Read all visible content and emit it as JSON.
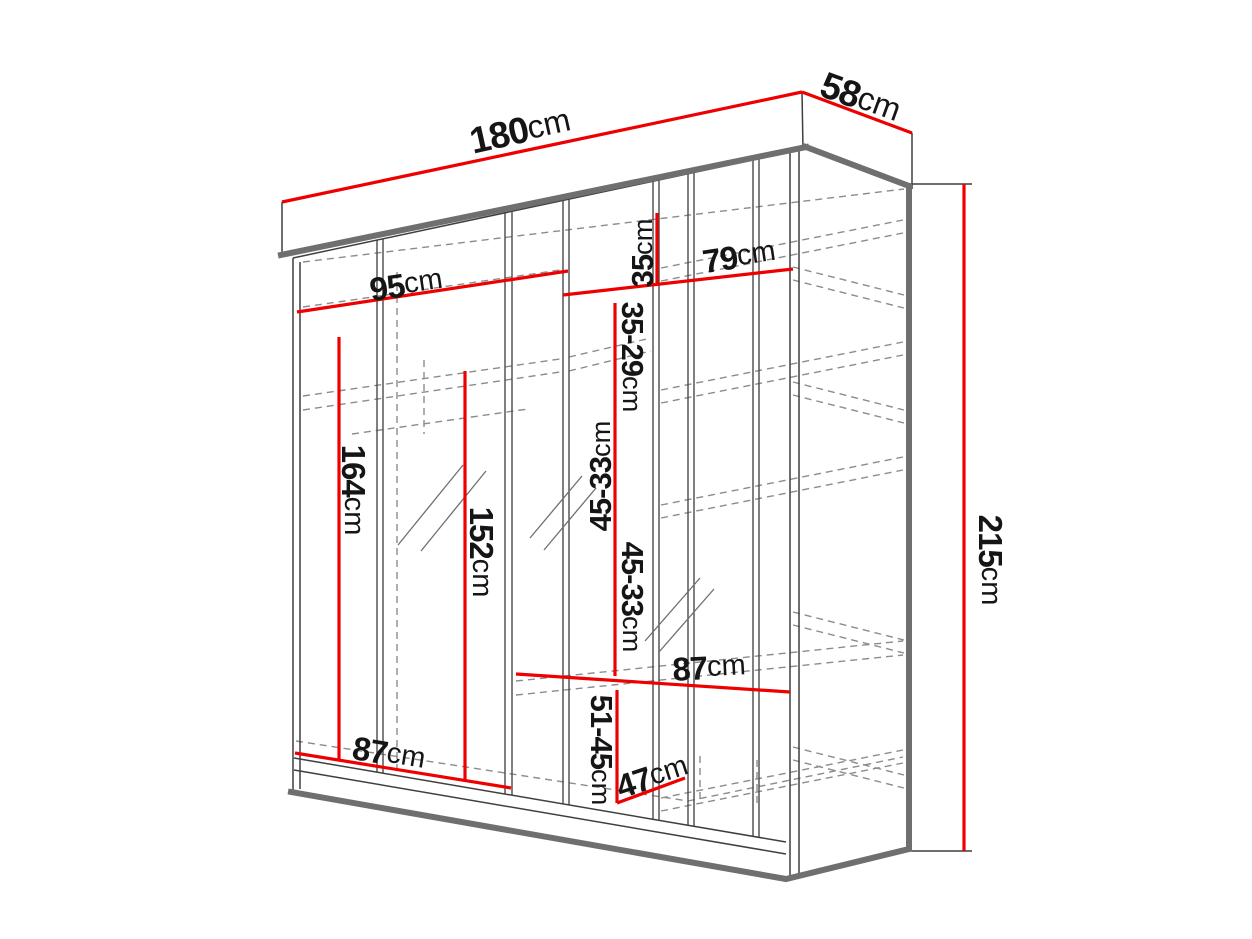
{
  "diagram": {
    "title": "Sliding wardrobe technical dimension drawing",
    "colors": {
      "dimension_line": "#ee0000",
      "structure_line": "#3f3f3f",
      "structure_thick": "#6f6f6f",
      "hidden_dashed": "#8c8c8c",
      "label_text": "#151515",
      "background": "#ffffff"
    },
    "dims": {
      "total_width": {
        "value": "180",
        "unit": "cm"
      },
      "total_depth": {
        "value": "58",
        "unit": "cm"
      },
      "total_height": {
        "value": "215",
        "unit": "cm"
      },
      "left_top_width": {
        "value": "95",
        "unit": "cm"
      },
      "right_top_width": {
        "value": "79",
        "unit": "cm"
      },
      "top_shelf_gap": {
        "value": "35",
        "unit": "cm"
      },
      "shelf_gap_1": {
        "value": "35-29",
        "unit": "cm"
      },
      "left_hanging_height": {
        "value": "164",
        "unit": "cm"
      },
      "mirror_height": {
        "value": "152",
        "unit": "cm"
      },
      "shelf_gap_2": {
        "value": "45-33",
        "unit": "cm"
      },
      "shelf_gap_3": {
        "value": "45-33",
        "unit": "cm"
      },
      "middle_shelf_width": {
        "value": "87",
        "unit": "cm"
      },
      "bottom_gap": {
        "value": "51-45",
        "unit": "cm"
      },
      "shelf_depth": {
        "value": "47",
        "unit": "cm"
      },
      "bottom_width": {
        "value": "87",
        "unit": "cm"
      }
    }
  }
}
